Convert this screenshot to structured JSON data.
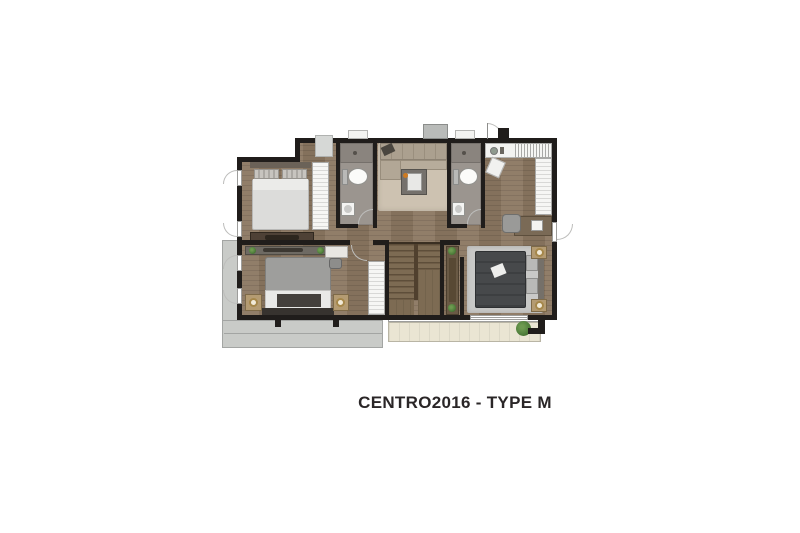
{
  "title": {
    "text": "CENTRO2016 - TYPE M"
  },
  "colors": {
    "wall": "#201d1b",
    "wood_floor": "#8b7761",
    "bathroom_floor": "#9b958f",
    "shower_floor": "#8a847e",
    "balcony_concrete": "#c9cbc8",
    "balcony_tile": "#eae5d3",
    "rug_beige": "#cdc2b1",
    "sofa_taupe": "#aba08f",
    "rug_gray": "#c9c9c7",
    "bed_dark": "#47494b",
    "bed_gray": "#9e9e9c",
    "headboard_dark": "#37332f",
    "furniture_white": "#f3f3f1",
    "stair_wood": "#7d6b53",
    "stair_stringer": "#50402e",
    "console_wood": "#6a5a45",
    "plant_green": "#4e7d3a",
    "lamp_gold": "#a5874a",
    "nightstand_wood": "#b49b72",
    "title_text": "#2a2627"
  }
}
